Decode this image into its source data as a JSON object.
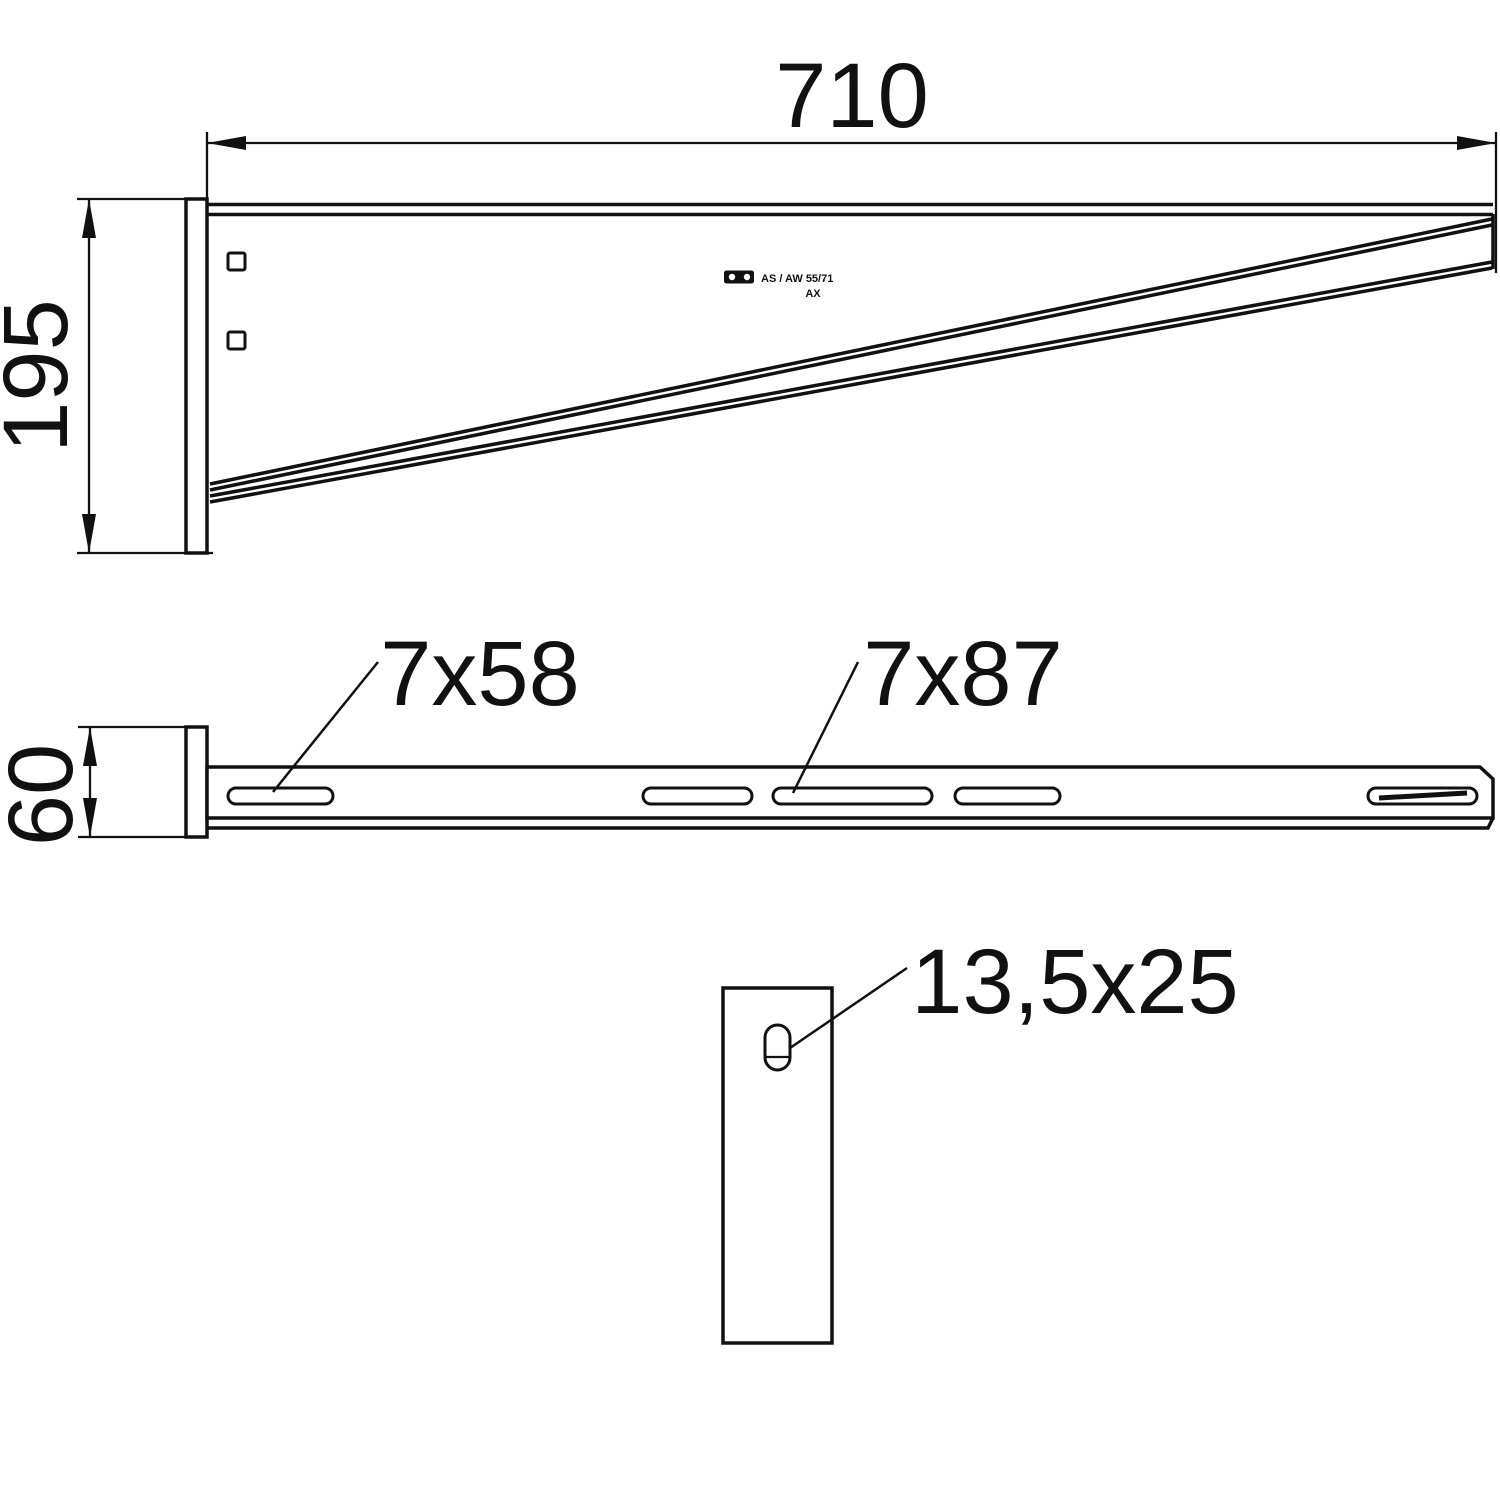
{
  "drawing": {
    "title": "Wall and support bracket technical drawing",
    "colors": {
      "ink": "#111111",
      "background": "#ffffff"
    },
    "side_view": {
      "length_dim": "710",
      "height_dim": "195",
      "stamp": {
        "logo": "obo-logo",
        "line1": "AS / AW 55/71",
        "line2": "AX"
      }
    },
    "plan_view": {
      "width_dim": "60",
      "slot_small_label": "7x58",
      "slot_large_label": "7x87"
    },
    "plate_view": {
      "slot_label": "13,5x25"
    }
  }
}
